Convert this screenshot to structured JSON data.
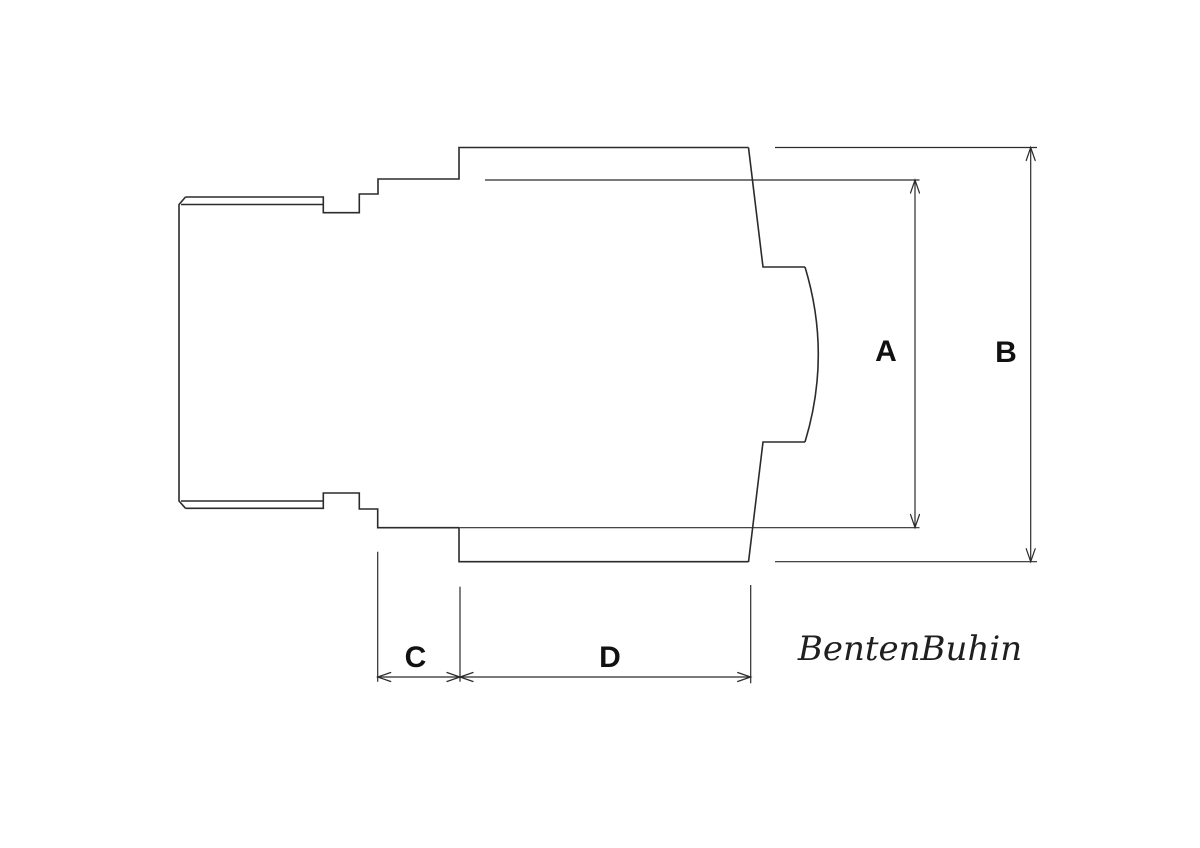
{
  "labels": {
    "dim_a": "A",
    "dim_b": "B",
    "dim_c": "C",
    "dim_d": "D"
  },
  "signature": {
    "text": "BentenBuhin"
  },
  "colors": {
    "background": "#ffffff",
    "line": "#2b2b2b",
    "label": "#111111",
    "signature": "#1f1f1f"
  }
}
